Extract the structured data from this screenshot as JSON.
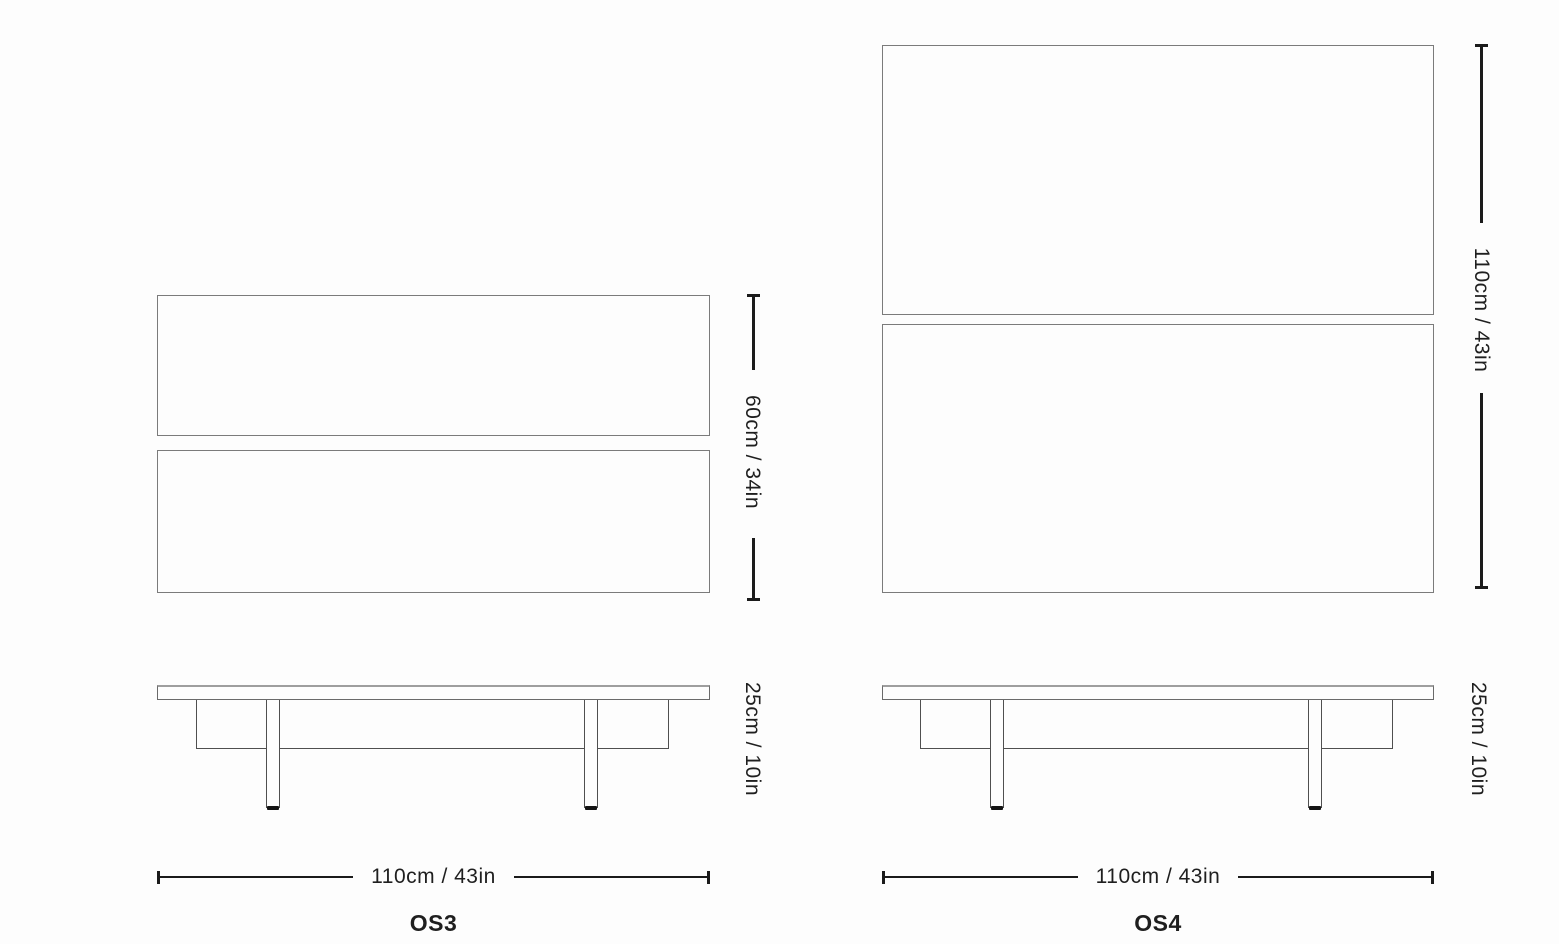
{
  "colors": {
    "background": "#fdfdfd",
    "panel_border": "#7b7b7b",
    "drawing_line": "#4f4f4f",
    "dimension_line": "#1b1b1b",
    "text": "#1f1f1f"
  },
  "diagrams": [
    {
      "model": "OS3",
      "depth_label": "60cm / 34in",
      "height_label": "25cm / 10in",
      "width_label": "110cm / 43in"
    },
    {
      "model": "OS4",
      "depth_label": "110cm / 43in",
      "height_label": "25cm / 10in",
      "width_label": "110cm / 43in"
    }
  ]
}
